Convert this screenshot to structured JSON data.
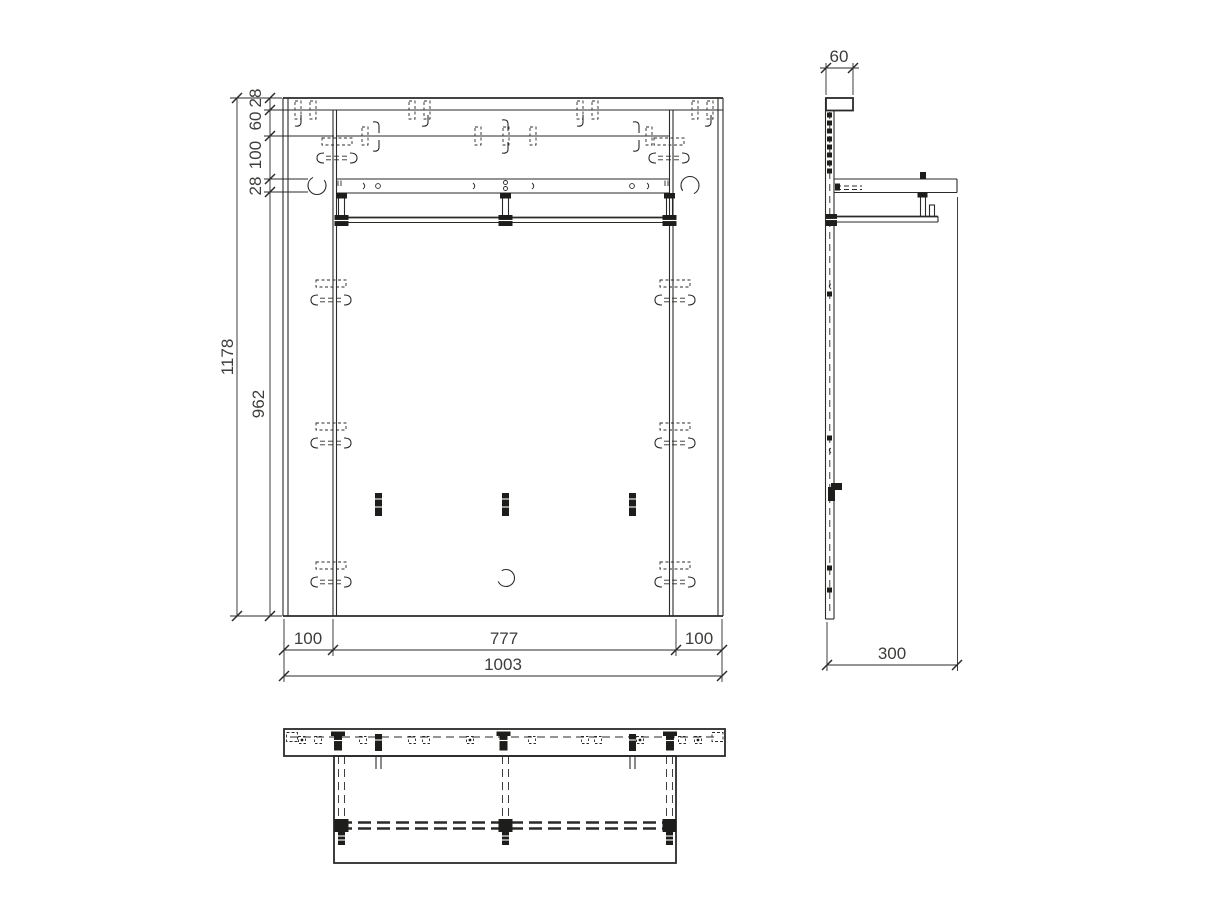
{
  "drawing": {
    "kind": "furniture technical drawing, three orthographic views of a wall panel with shelf and hanging rail",
    "line_color": "#2a2a28",
    "background": "#ffffff",
    "views": {
      "front": {
        "name": "front view"
      },
      "side": {
        "name": "side view"
      },
      "top": {
        "name": "top view"
      }
    }
  },
  "dims": {
    "front_vertical": {
      "top_board": "28",
      "top_gap": "60",
      "upper_zone": "100",
      "shelf_thickness": "28",
      "body": "962",
      "overall": "1178"
    },
    "front_horizontal": {
      "left_inset": "100",
      "center": "777",
      "right_inset": "100",
      "overall": "1003"
    },
    "side": {
      "top_depth": "60",
      "shelf_depth": "300"
    }
  }
}
